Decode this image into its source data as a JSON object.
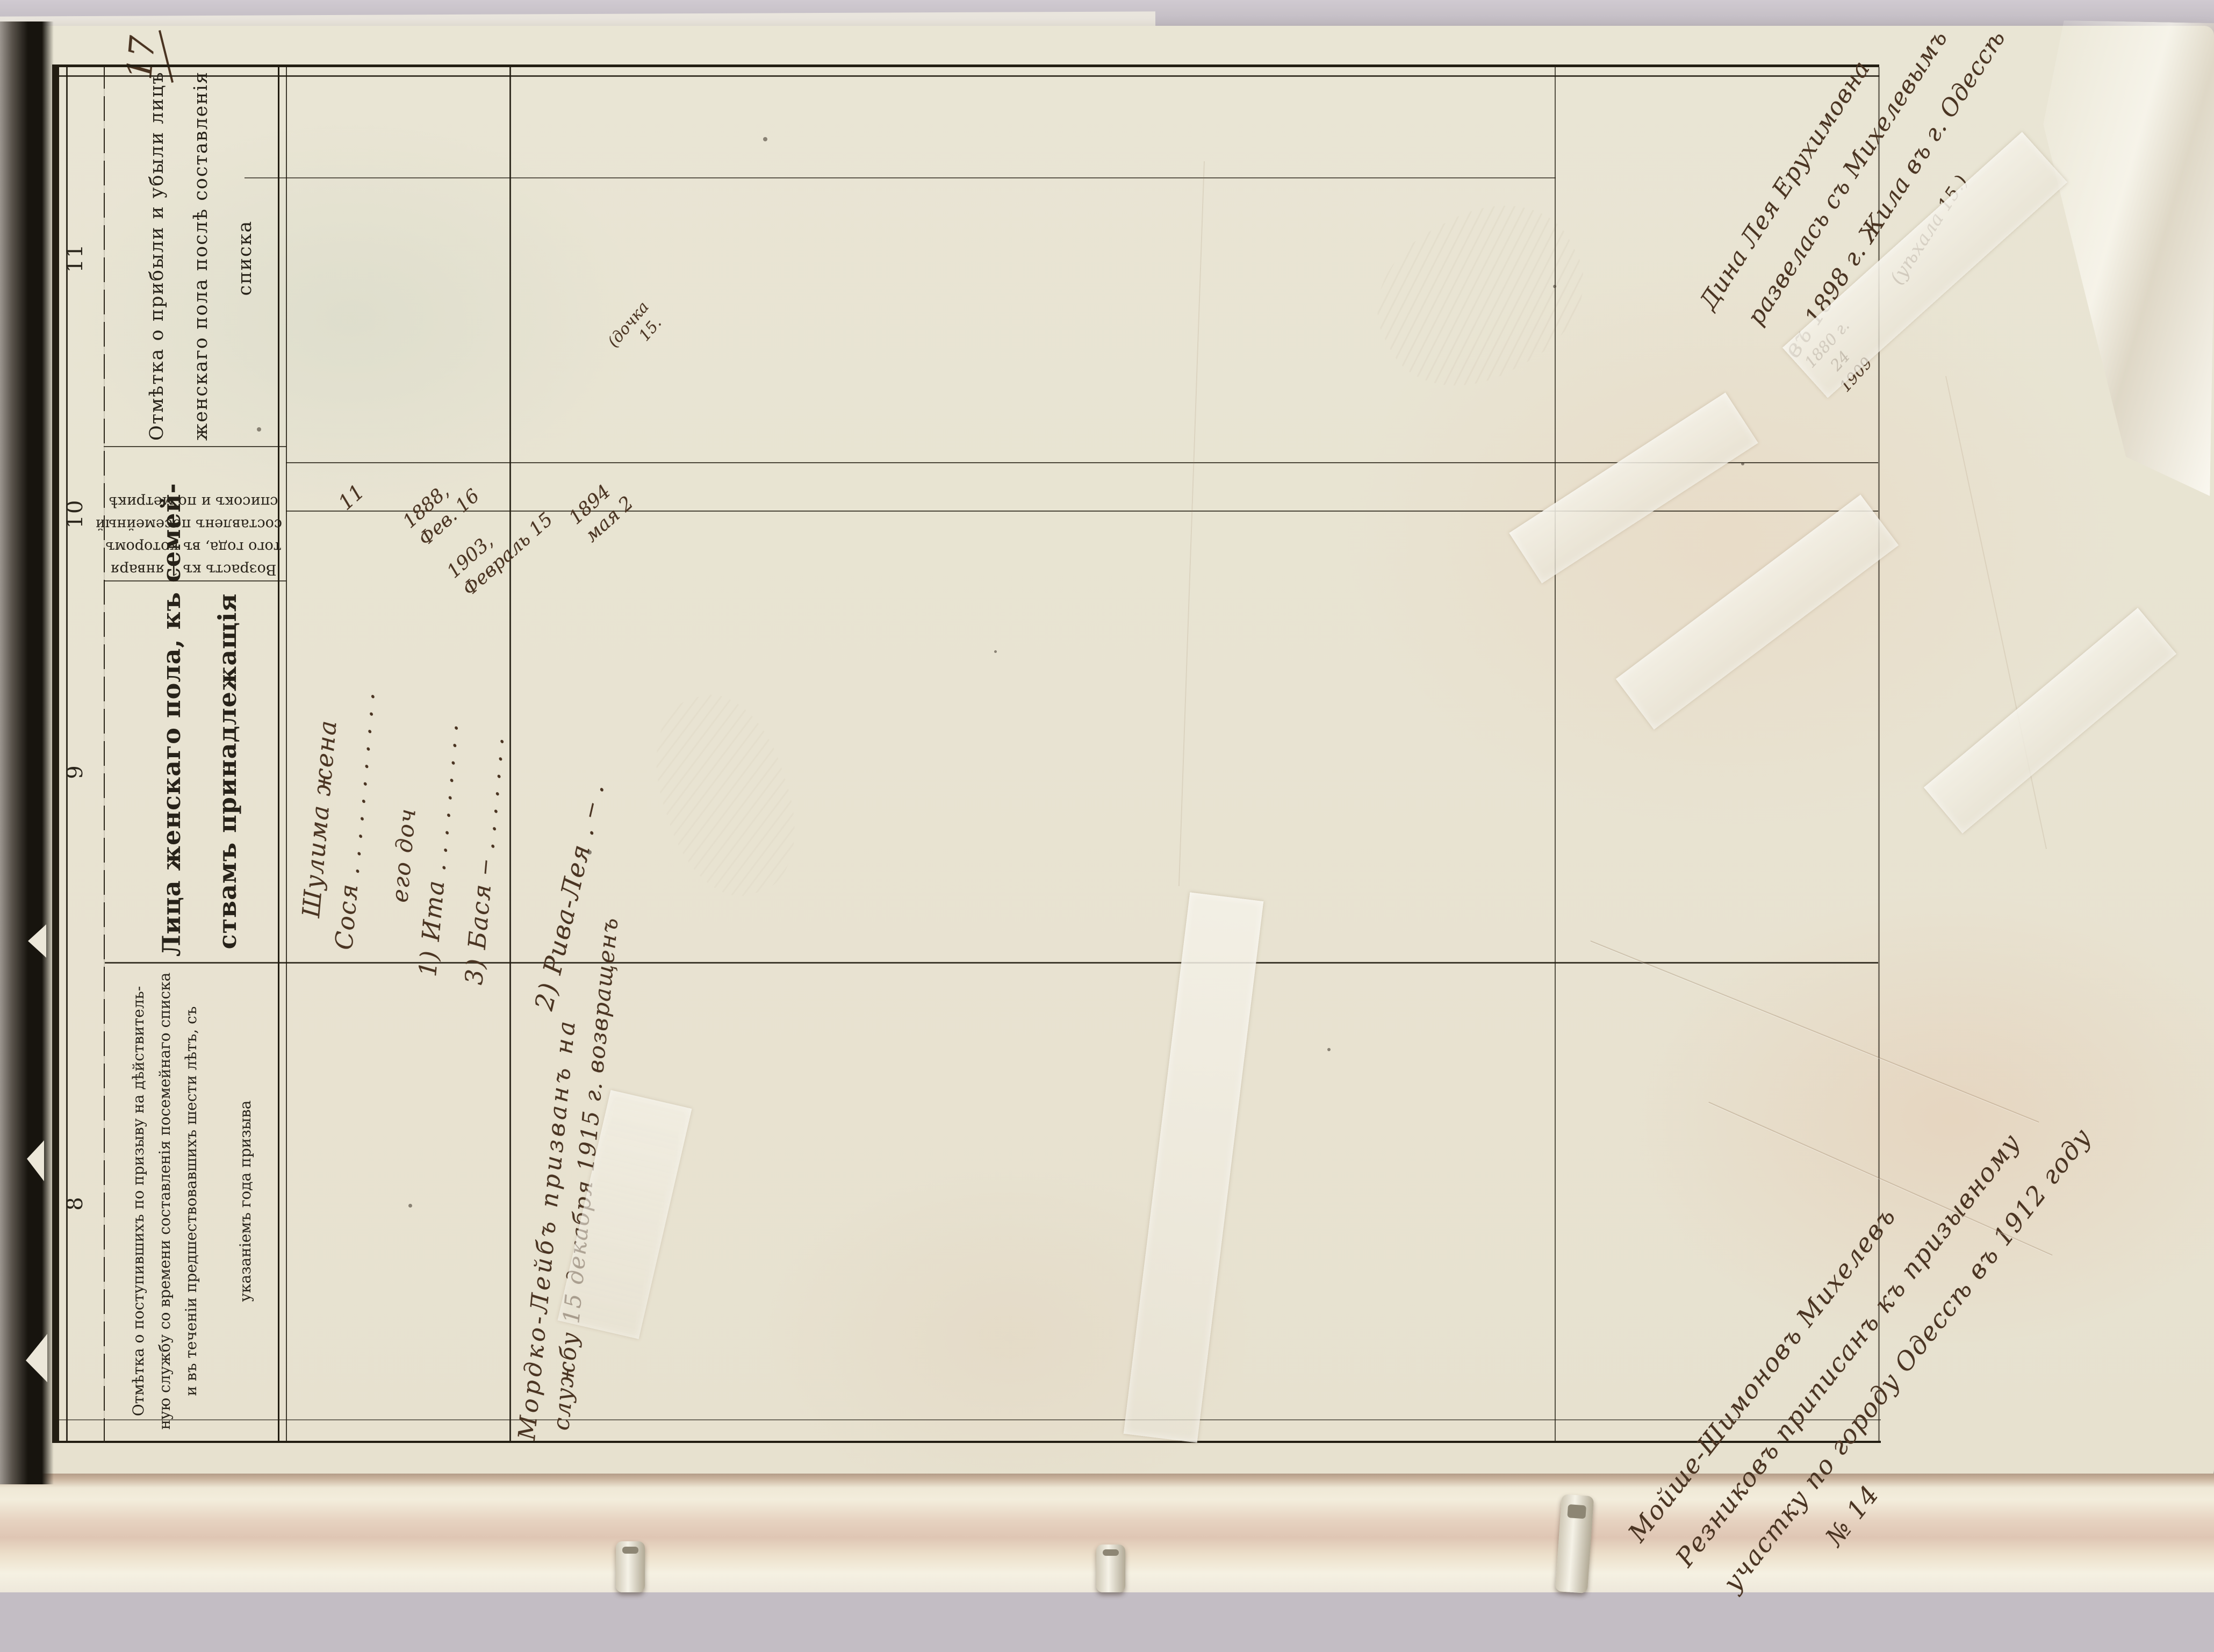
{
  "page": {
    "number": "17"
  },
  "table": {
    "column_numbers": [
      "8",
      "9",
      "10",
      "11"
    ],
    "headers": {
      "col8_lines": [
        "Отмѣтка о поступившихъ по призыву на дѣйствитель-",
        "ную службу со времени составленія посемейнаго списка",
        "и въ теченіи предшествовавшихъ шести лѣтъ, съ",
        "указаніемъ года призыва"
      ],
      "col9_lines": [
        "Лица женскаго пола, къ семей-",
        "ствамъ принадлежащія"
      ],
      "col10_lines": [
        "Возрастъ къ 1 января",
        "того года, въ которомъ",
        "составленъ посемейный",
        "списокъ и по метрикѣ"
      ],
      "col11_lines": [
        "Отмѣтка о прибыли и убыли лицъ",
        "женскаго пола послѣ составленія",
        "списка"
      ]
    }
  },
  "entries": {
    "family1": {
      "wife_line1": "Шулима жена",
      "wife_line2": "Сося . . . . . . . . . . .",
      "daughters_label": "его доч",
      "daughter1": "1) Ита . . . . . . . . .",
      "daughter2": "3) Бася ‒ . . . . . . .",
      "age_wife": "11",
      "birth_ita": [
        "1888,",
        "Фев. 16"
      ],
      "birth_basya": [
        "1903,",
        "Февраль 15"
      ]
    },
    "family2": {
      "daughter": "2) Рива-Лея . ‒ .",
      "birth": [
        "1894",
        "мая 2"
      ],
      "note": [
        "(дочка",
        "15."
      ]
    },
    "col8_note": [
      "Мордко-Лейбъ призванъ на",
      "службу 15 декабря 1915 г. возвращенъ"
    ],
    "col11_note": {
      "dates": [
        "1880 г.",
        "24",
        "1909"
      ],
      "lines": [
        "Дина Лея Ерухимовна",
        "развелась съ Михелевымъ",
        "въ 1898 г. Жила въ г. Одессѣ",
        "(уѣхала 15.)"
      ]
    },
    "bottom_note": [
      "Мойше-Шимоновъ Михелевъ",
      "Резниковъ приписанъ къ призывному",
      "участку по городу Одессѣ въ 1912 году",
      "№ 14"
    ]
  },
  "colors": {
    "paper": "#e9e5d4",
    "paper_warm": "#e8dbc8",
    "backdrop": "#c3bdc4",
    "ink_print": "#272219",
    "ink_hand": "#4a3422",
    "frame_line": "#1c1812",
    "tape": "#f1eee6"
  }
}
